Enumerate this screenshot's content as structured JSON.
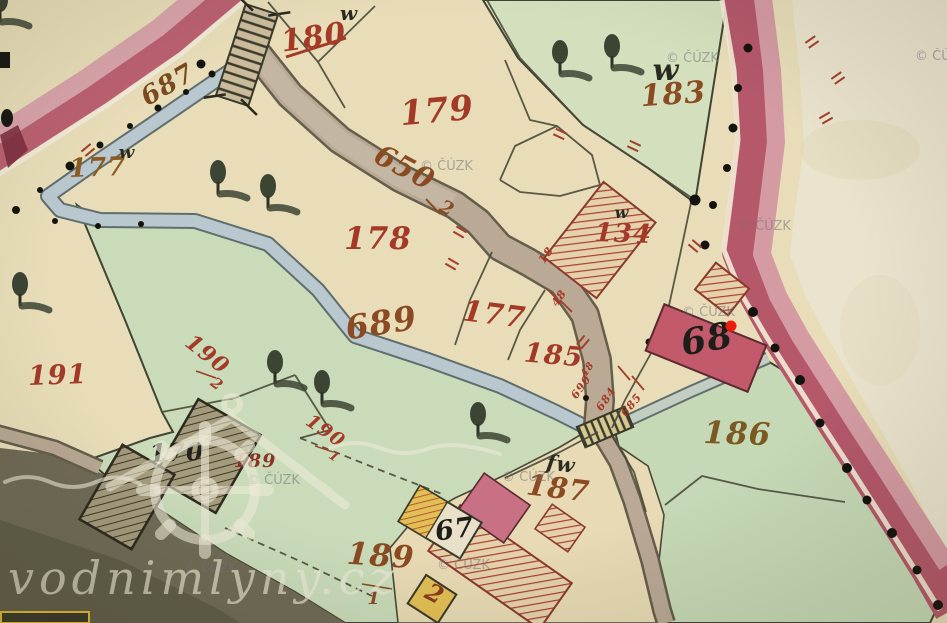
{
  "watermarks": {
    "cuzk": "© ČÚZK",
    "site": "vodnimlyny.cz"
  },
  "labels": {
    "stream_687": "687",
    "parcel_180_struck": "180",
    "parcel_179": "179",
    "parcel_183": "183",
    "parcel_177_nw": "177",
    "parcel_178": "178",
    "path_650_num": "650",
    "path_650_den": "2",
    "stream_689": "689",
    "parcel_177_mid": "177",
    "parcel_185": "185",
    "parcel_134": "134",
    "parcel_191": "191",
    "parcel_190_2_num": "190",
    "parcel_190_2_den": "2",
    "parcel_190_1_num": "190",
    "parcel_190_1_den": "1",
    "house_170": "170",
    "parcel_189_small": "189",
    "parcel_189_1_num": "189",
    "parcel_189_1_den": "1",
    "script_fw": "fw",
    "parcel_187": "187",
    "parcel_186": "186",
    "house_68": "68",
    "house_67": "67",
    "house_2": "2",
    "junction_690": "690",
    "junction_684": "684",
    "junction_685": "685",
    "junction_48": "48",
    "near_building_18": "18",
    "near_building_48": "48",
    "meadow_w_top": "w",
    "meadow_w_177": "w",
    "meadow_w_183": "w",
    "meadow_w_134": "w"
  },
  "colors": {
    "road": "#b4586a",
    "road_light": "#d49ba2",
    "stream": "#b9c7ce",
    "green_parcel": "#c9dbb9",
    "beige_parcel": "#e8ddb8",
    "building_masonry": "#c25a6c",
    "building_wood_hatch": "#a8402e",
    "building_yellow": "#e2bf55",
    "marker_red": "#ed1c0c"
  }
}
